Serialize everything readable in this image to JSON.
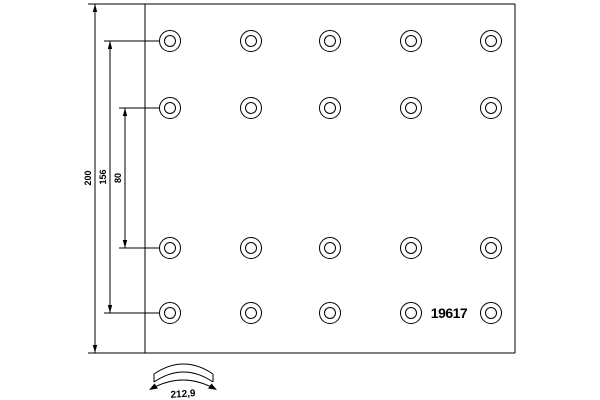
{
  "drawing": {
    "type": "brake-lining-technical-drawing",
    "background_color": "#ffffff",
    "line_color": "#000000",
    "part_number": "19617",
    "dimensions": {
      "total_width": "200",
      "outer_hole_row_spacing": "156",
      "inner_hole_row_spacing": "80",
      "arc_width": "212,9"
    },
    "hole_grid": {
      "columns": [
        170,
        251,
        330,
        411,
        491
      ],
      "rows": [
        41,
        108,
        248,
        313
      ],
      "outer_radius": 10.5,
      "inner_radius": 5.5
    }
  }
}
